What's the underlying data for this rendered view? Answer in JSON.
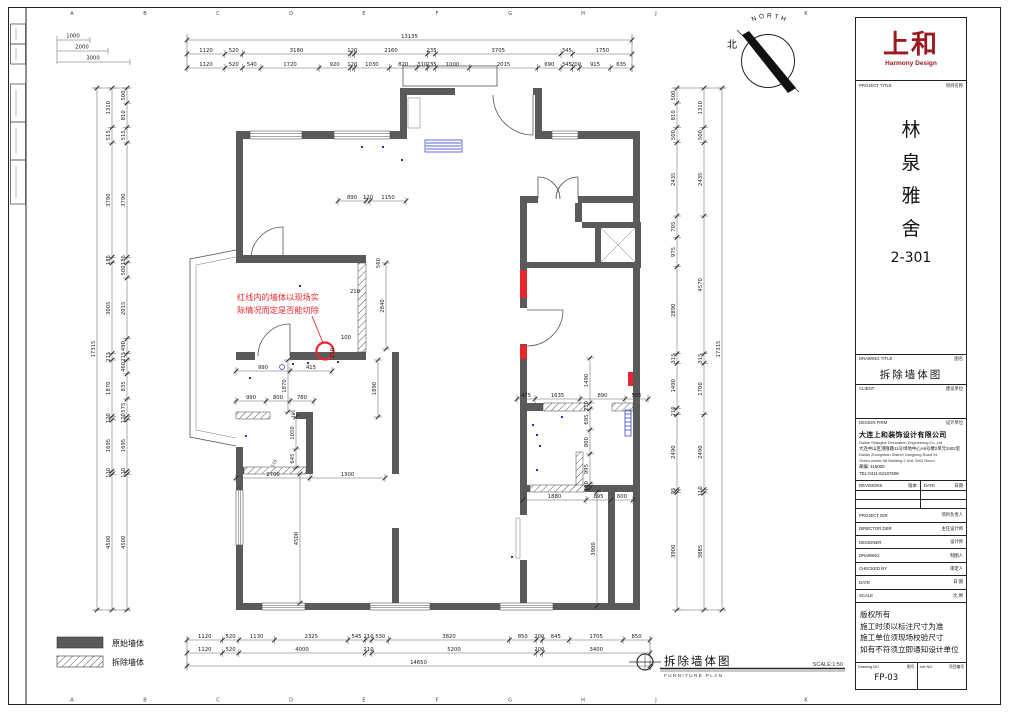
{
  "sheet": {
    "grid_top": [
      "A",
      "B",
      "C",
      "D",
      "E",
      "F",
      "G",
      "H",
      "J",
      "K"
    ],
    "grid_bottom": [
      "A",
      "B",
      "C",
      "D",
      "E",
      "F",
      "G",
      "H",
      "J",
      "K"
    ],
    "scalebars": [
      "1000",
      "2000",
      "3000"
    ],
    "north_zh": "北",
    "north_en": "NORTH"
  },
  "annotation": {
    "line1": "红线内的墙体以现场实",
    "line2": "际情况而定是否能切除"
  },
  "legend": {
    "original": "原始墙体",
    "demolish": "拆除墙体"
  },
  "plan_label": {
    "title": "拆除墙体图",
    "subtitle": "FURNITURE PLAN",
    "scale": "SCALE:1:50"
  },
  "dims": {
    "top_total": [
      "13135"
    ],
    "top_mid": [
      "1120",
      "520",
      "3180",
      "120",
      "2160",
      "235",
      "3705",
      "345",
      "1750"
    ],
    "top_inner": [
      "1120",
      "520",
      "540",
      "1720",
      "920",
      "120",
      "1030",
      "820",
      "310",
      "235",
      "1000",
      "2015",
      "690",
      "345",
      "200",
      "915",
      "635"
    ],
    "bottom_inner": [
      "1120",
      "520",
      "1130",
      "2325",
      "545",
      "210",
      "530",
      "3820",
      "850",
      "200",
      "845",
      "1705",
      "850"
    ],
    "bottom_mid": [
      "1120",
      "520",
      "4000",
      "210",
      "5200",
      "200",
      "3400"
    ],
    "bottom_total": [
      "14650"
    ],
    "left_total": [
      "17315"
    ],
    "left_mid": [
      "1310",
      "515",
      "3790",
      "185",
      "3005",
      "215",
      "1870",
      "120",
      "1695",
      "110",
      "4500"
    ],
    "left_inner": [
      "500",
      "810",
      "515",
      "3790",
      "185",
      "500",
      "2015",
      "490",
      "215",
      "460",
      "835",
      "575",
      "120",
      "1695",
      "110",
      "4500"
    ],
    "right_inner": [
      "500",
      "810",
      "500",
      "2435",
      "705",
      "975",
      "2890",
      "315",
      "1490",
      "210",
      "2490",
      "95",
      "3900"
    ],
    "right_outer": [
      "1310",
      "500",
      "2435",
      "4570",
      "315",
      "1700",
      "2490",
      "110",
      "3885"
    ],
    "right_total": [
      "17315"
    ],
    "entry": [
      "890",
      "120",
      "1150"
    ],
    "mid_a": [
      "990",
      "415"
    ],
    "mid_b": [
      "990",
      "800",
      "780"
    ],
    "mid_c": [
      "2700",
      "1300"
    ],
    "kitchen_top": [
      "475",
      "1635",
      "890",
      "505"
    ],
    "kitchen_bottom": [
      "1880",
      "895",
      "600"
    ],
    "kitchen_v": [
      "1490",
      "210",
      "695",
      "800",
      "995",
      "110"
    ],
    "v1870": [
      "1870"
    ],
    "v1890": [
      "1890"
    ],
    "v2840": [
      "2840"
    ],
    "v1050": [
      "1050",
      "645"
    ],
    "v4500": [
      "4500"
    ],
    "v3900": [
      "3900"
    ],
    "singles": {
      "d100": "100",
      "d210a": "210",
      "d210b": "210",
      "d560": "560",
      "d180": "180",
      "d110": "110"
    }
  },
  "titleblock": {
    "logo_zh": "上和",
    "logo_en": "Harmony Design",
    "project_title_en": "PROJECT TITLE",
    "project_title_zh": "项目名称",
    "project_name": [
      "林",
      "泉",
      "雅",
      "舍"
    ],
    "project_no": "2-301",
    "drawing_title_en": "DRAWING TITLE",
    "drawing_title_zh": "图名",
    "drawing_title": "拆除墙体图",
    "client_en": "CLIENT",
    "client_zh": "建设单位",
    "firm_en": "DESIGN FIRM",
    "firm_zh": "设计单位",
    "firm_name_zh": "大连上和装饰设计有限公司",
    "firm_name_en": "Dalian Shanghe Decoration Engineering Co.,Ltd",
    "firm_addr_zh": "大连中山区港隆路11号绿地中心A6号楼2单元3402室",
    "firm_addr_en1": "Dalian Zhongshan District Ganglong Road 14",
    "firm_addr_en2": "Green center A6 Building 2 Unit 3402 Room",
    "firm_post": "邮编: 116000",
    "firm_tel": "TEL:0411-62187608",
    "revisions_en": "REVISIONS",
    "revisions_zh": "版本",
    "date_en": "DATE",
    "date_zh": "日期",
    "roles": [
      {
        "en": "PROJECT DIR",
        "zh": "项目负责人"
      },
      {
        "en": "DIRECTOR DER",
        "zh": "主任设计师"
      },
      {
        "en": "DESIGNER",
        "zh": "设计师"
      },
      {
        "en": "DRAWING",
        "zh": "制图人"
      },
      {
        "en": "CHECKED BY",
        "zh": "审定人"
      },
      {
        "en": "DATE",
        "zh": "日  期"
      },
      {
        "en": "SCALE",
        "zh": "比  例"
      }
    ],
    "notes": [
      "版权所有",
      "施工时须以标注尺寸为准",
      "施工单位须现场校验尺寸",
      "如有不符须立即通知设计单位"
    ],
    "drawing_no_en": "Drawing NO",
    "drawing_no_zh": "图号",
    "drawing_no": "FP-03",
    "job_no_en": "Job NO",
    "job_no_zh": "项目编号"
  }
}
